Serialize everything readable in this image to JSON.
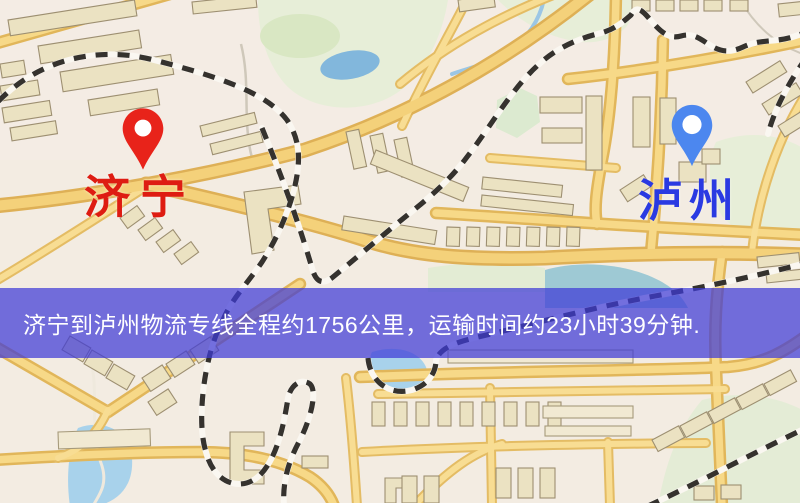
{
  "route": {
    "origin": "济宁",
    "destination": "泸州",
    "origin_label_color": "#de1c12",
    "origin_pin_color": "#e8231a",
    "destination_label_color": "#2a3ae2",
    "destination_pin_color": "#4c87ef"
  },
  "banner": {
    "text": "济宁到泸州物流专线全程约1756公里，运输时间约23小时39分钟.",
    "background": "rgba(62,58,215,0.72)",
    "text_color": "#ffffff"
  },
  "map_palette": {
    "background": "#f3ece2",
    "road_fill": "#f5d88a",
    "road_casing": "#e0b65c",
    "building_fill": "#ebe2c3",
    "building_outline": "#9d8f72",
    "park_green": "#e7eed8",
    "water_blue": "#83b7db",
    "railway_dark": "#35322e"
  }
}
